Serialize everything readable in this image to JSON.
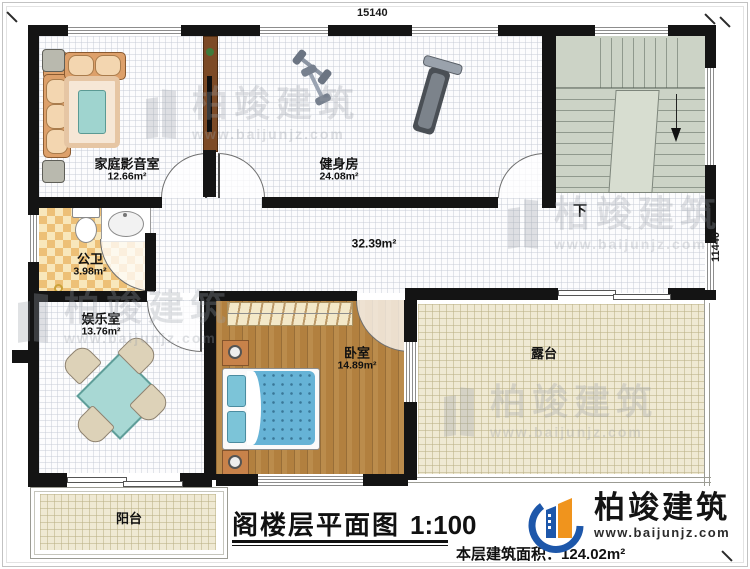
{
  "dims": {
    "width": "15140",
    "height": "11440"
  },
  "rooms": {
    "theater": {
      "name": "家庭影音室",
      "area": "12.66m²"
    },
    "gym": {
      "name": "健身房",
      "area": "24.08m²"
    },
    "bath": {
      "name": "公卫",
      "area": "3.98m²"
    },
    "play": {
      "name": "娱乐室",
      "area": "13.76m²"
    },
    "bedroom": {
      "name": "卧室",
      "area": "14.89m²"
    },
    "terrace": {
      "name": "露台"
    },
    "balcony": {
      "name": "阳台"
    },
    "hall": {
      "area": "32.39m²"
    }
  },
  "stairs": {
    "down": "下"
  },
  "titleblock": {
    "title": "阁楼层平面图",
    "scale": "1:100",
    "area_label": "本层建筑面积：",
    "area_value": "124.02m²"
  },
  "brand": {
    "name": "柏竣建筑",
    "site": "www.baijunjz.com"
  },
  "watermark": {
    "name": "柏竣建筑",
    "site": "www.baijunjz.com"
  },
  "colors": {
    "wall": "#141414",
    "stairs": "#ccd3c6",
    "wood_floor": "#b2803f",
    "bath_tile": "#edc077",
    "terrace": "#efe9d3",
    "mattress": "#66b3d6",
    "logo_blue": "#1d57aa",
    "logo_orange": "#f0941d"
  }
}
